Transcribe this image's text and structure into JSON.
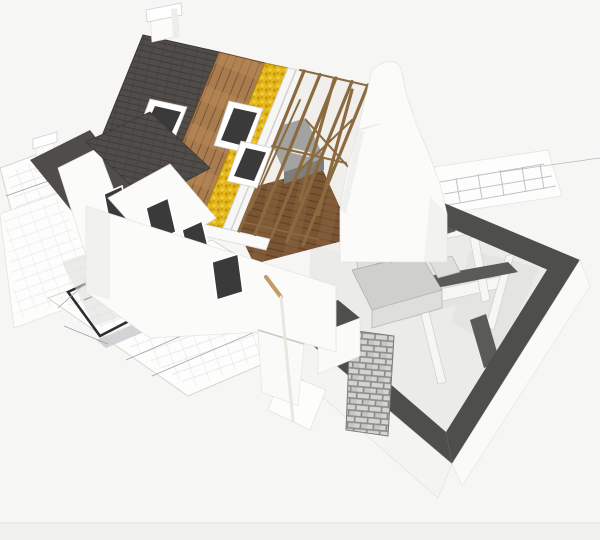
{
  "image": {
    "subject": "3D cutaway architectural rendering of a partially built house standing on unrolled floor-plan blueprints",
    "style": "isometric white-background product-style render",
    "visible_text": "none"
  },
  "palette": {
    "background": "#f6f6f5",
    "bottom_strip": "#f1f1ef",
    "paper": "#fdfdfc",
    "paper_edge": "#d6d6d4",
    "plan_line_faint": "#b9bec6",
    "plan_wall_dark": "#2e2e2e",
    "plan_band_gray": "#c7c9cb",
    "shingle_dark": "#4f4c49",
    "shingle_line": "#3f3c39",
    "roof_wood": "#a87c4f",
    "roof_wood_line": "#7d5531",
    "insulation_yellow": "#e5b91e",
    "insulation_shadow": "#c28f12",
    "rafter_wood": "#8a6a3e",
    "attic_floor": "#7a5433",
    "attic_floor_line": "#5e3e24",
    "white_wall": "#fbfbfa",
    "wall_shade": "#ededea",
    "window_dark": "#3a3a3a",
    "frame_white": "#ffffff",
    "wall_top_dark": "#4e4e4c",
    "interior_floor": "#ebebe9",
    "interior_shadow": "#6c6c6a",
    "cabinet_gray": "#cfcfcd",
    "brick_light": "#d4d4d2",
    "brick_mortar": "#8b8b89",
    "furniture_gray": "#a2a2a0",
    "stick_tan": "#c49a66",
    "stick_white": "#ebe6df"
  },
  "scene": {
    "elements": [
      "blueprint sheets on ground",
      "thick-wall floor plan drawing",
      "house with layered cutaway roof: shingles, wood sheathing, yellow insulation, battens, open rafters",
      "chimney on ridge",
      "roof skylight windows",
      "left wing gables with dark roofs and windows",
      "white dutch-gable end wall",
      "exposed attic with wooden floor",
      "ground-floor cutaway with dark wall tops, kitchen cabinets and brick wall section",
      "broom leaning on front wall"
    ]
  }
}
